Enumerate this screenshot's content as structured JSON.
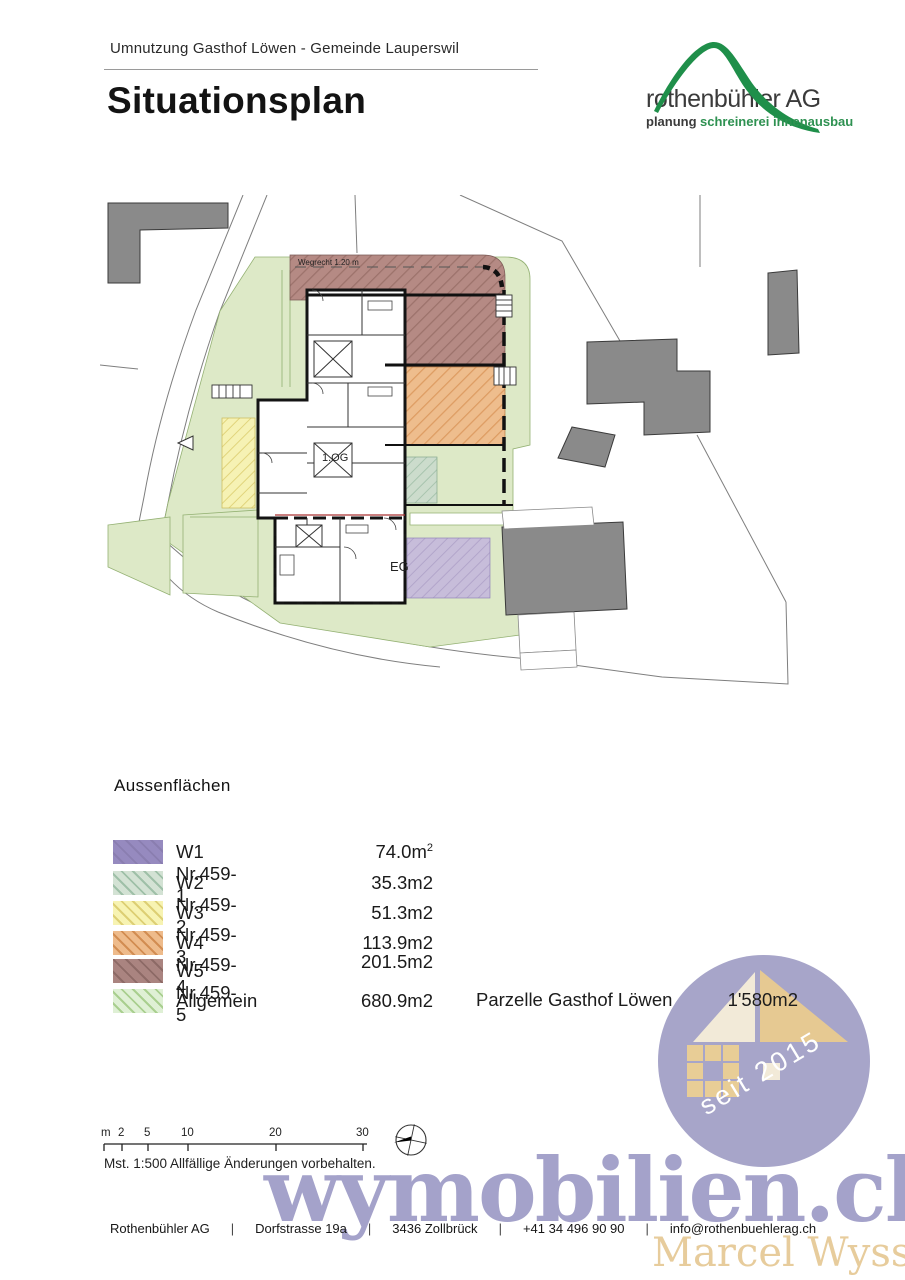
{
  "header": {
    "project": "Umnutzung Gasthof Löwen - Gemeinde Lauperswil",
    "title": "Situationsplan"
  },
  "logo": {
    "name": "rothenbühler AG",
    "tagline_planung": "planung",
    "tagline_schreinerei": "schreinerei",
    "tagline_innenausbau": "innenausbau",
    "green": "#2e9151",
    "dark": "#3b3b3b"
  },
  "plan": {
    "labels": {
      "wegrecht": "Wegrecht 1.20 m",
      "upper_floor": "1.OG",
      "ground_floor": "EG"
    },
    "colors": {
      "site_green": "#dde9c7",
      "w1_purple": "#c7bdda",
      "w2_green": "#ccdccc",
      "w3_yellow": "#f6f2b4",
      "w4_orange": "#eebd8d",
      "w5_brown": "#b58a84",
      "neighbor_gray": "#8a8a8a"
    }
  },
  "legend": {
    "heading": "Aussenflächen",
    "items": [
      {
        "label": "W1 Nr.459-1",
        "value": "74.0m",
        "sup": "2",
        "color": "#968abf"
      },
      {
        "label": "W2 Nr.459-2",
        "value": "35.3m2",
        "sup": "",
        "color": "#d3e2d4"
      },
      {
        "label": "W3 Nr.459-3",
        "value": "51.3m2",
        "sup": "",
        "color": "#f7f3b2"
      },
      {
        "label": "W4 Nr.459-4",
        "value": "113.9m2",
        "sup": "",
        "color": "#eebb8b"
      },
      {
        "label": "W5 Nr.459-5",
        "value": "201.5m2",
        "sup": "",
        "color": "#aa8480"
      },
      {
        "label": "Allgemein",
        "value": "680.9m2",
        "sup": "",
        "color": "#dff0d5"
      }
    ],
    "parcel_label": "Parzelle Gasthof Löwen",
    "parcel_value": "1'580m2"
  },
  "scalebar": {
    "labels": [
      "m",
      "2",
      "5",
      "10",
      "20",
      "30"
    ],
    "note": "Mst. 1:500 Allfällige Änderungen vorbehalten."
  },
  "badge": {
    "text": "seit 2015",
    "circle_color": "#a7a5c9",
    "roof_light": "#f2ead8",
    "roof_dark": "#e6c992",
    "squares": "#e8cd96"
  },
  "watermark": {
    "site": "wymobilien.ch",
    "owner": "Marcel Wyss",
    "site_color": "#a4a2ca",
    "owner_color": "#e7cc9c"
  },
  "footer": {
    "separator": "|",
    "items": [
      "Rothenbühler AG",
      "Dorfstrasse 19a",
      "3436 Zollbrück",
      "+41 34 496 90 90",
      "info@rothenbuehlerag.ch"
    ]
  }
}
